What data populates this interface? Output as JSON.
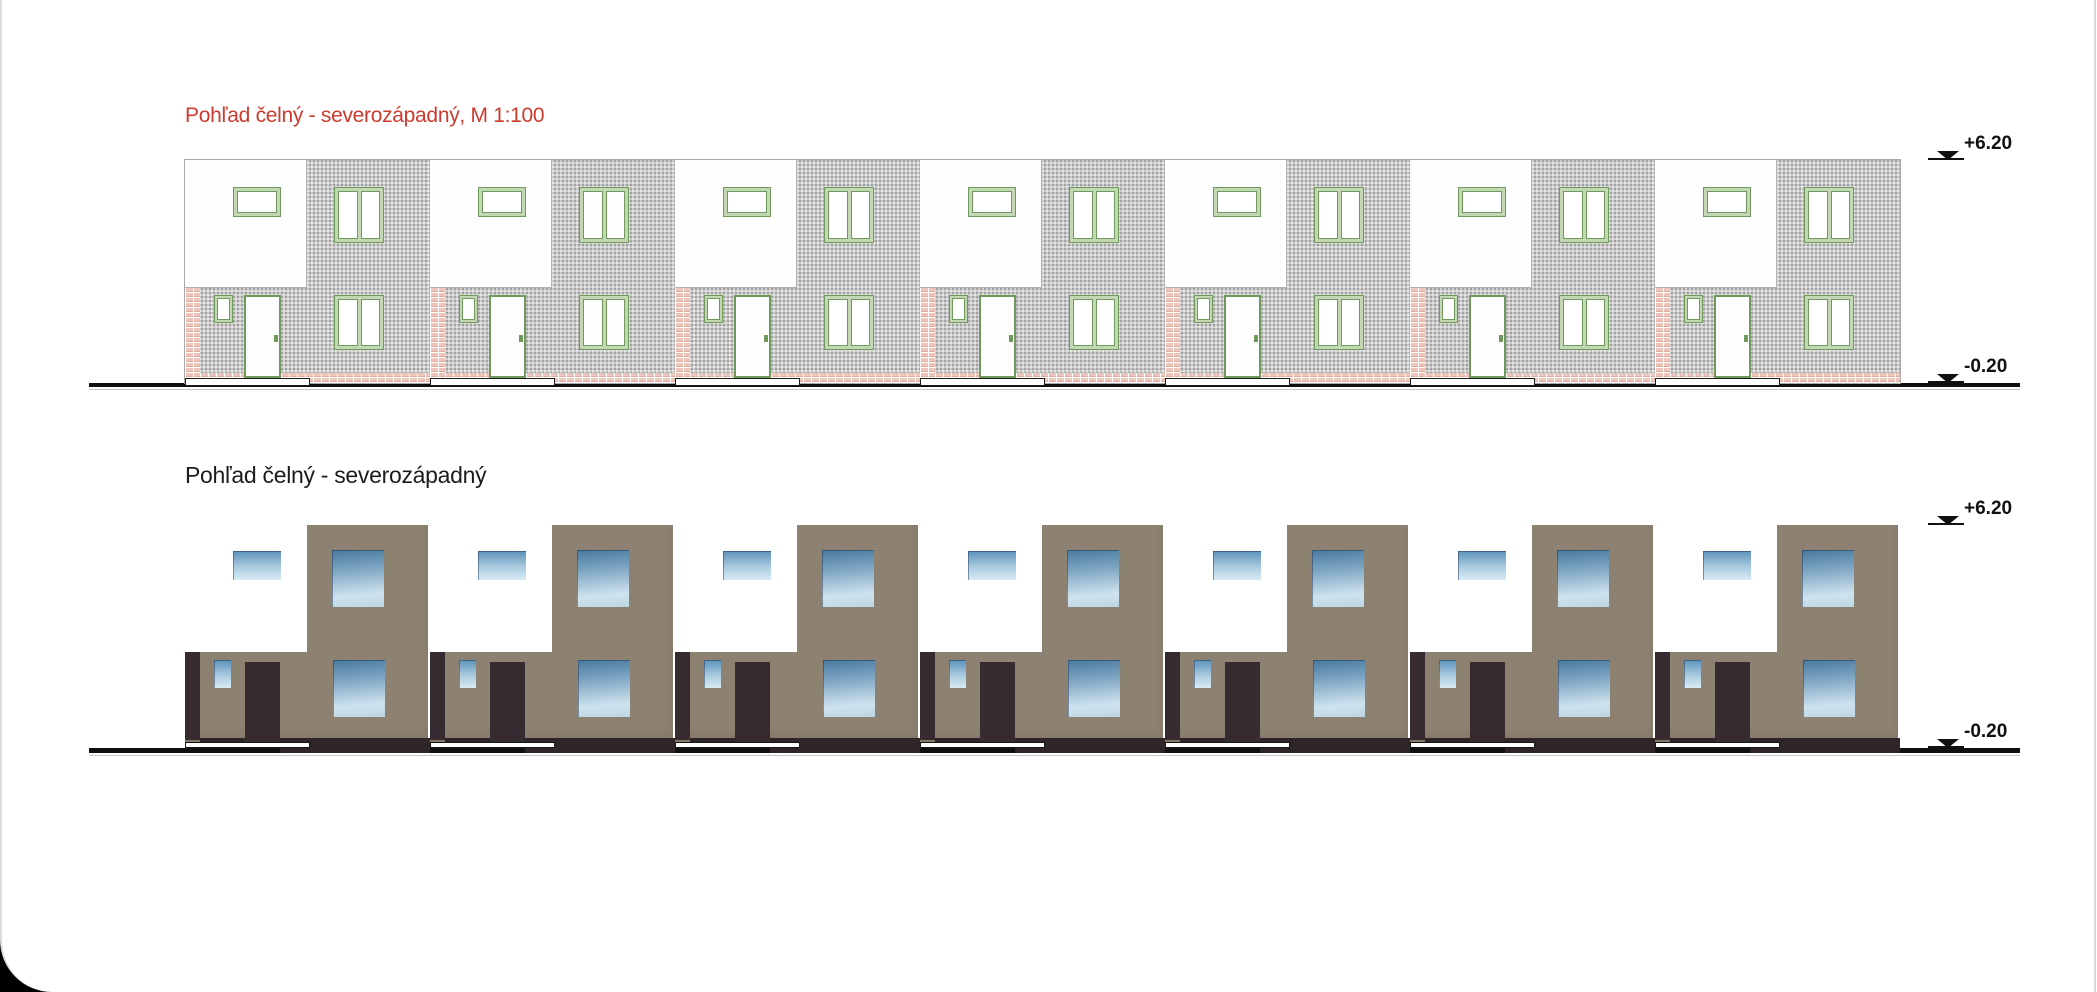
{
  "page": {
    "background": "#ffffff",
    "outer_background": "#000000"
  },
  "colors": {
    "title_red": "#cc3b2e",
    "title_black": "#1c1c1c",
    "plaster_gray": "#cbcbcb",
    "frame_green": "#6f9a5c",
    "frame_green_light": "#c4d7b5",
    "brick_pink": "#eec5bb",
    "wall_brown": "#8d8172",
    "dark_door": "#362b31",
    "plinth_dark": "#2e2529",
    "window_blue_top": "#49799f",
    "window_blue_light": "#d8ebf5",
    "ground_black": "#101010"
  },
  "top_view": {
    "title": "Pohľad čelný - severozápadný, M 1:100",
    "unit_count": 7,
    "elevation_top": "+6.20",
    "elevation_bottom": "-0.20"
  },
  "bottom_view": {
    "title": "Pohľad čelný - severozápadný",
    "unit_count": 7,
    "elevation_top": "+6.20",
    "elevation_bottom": "-0.20"
  }
}
